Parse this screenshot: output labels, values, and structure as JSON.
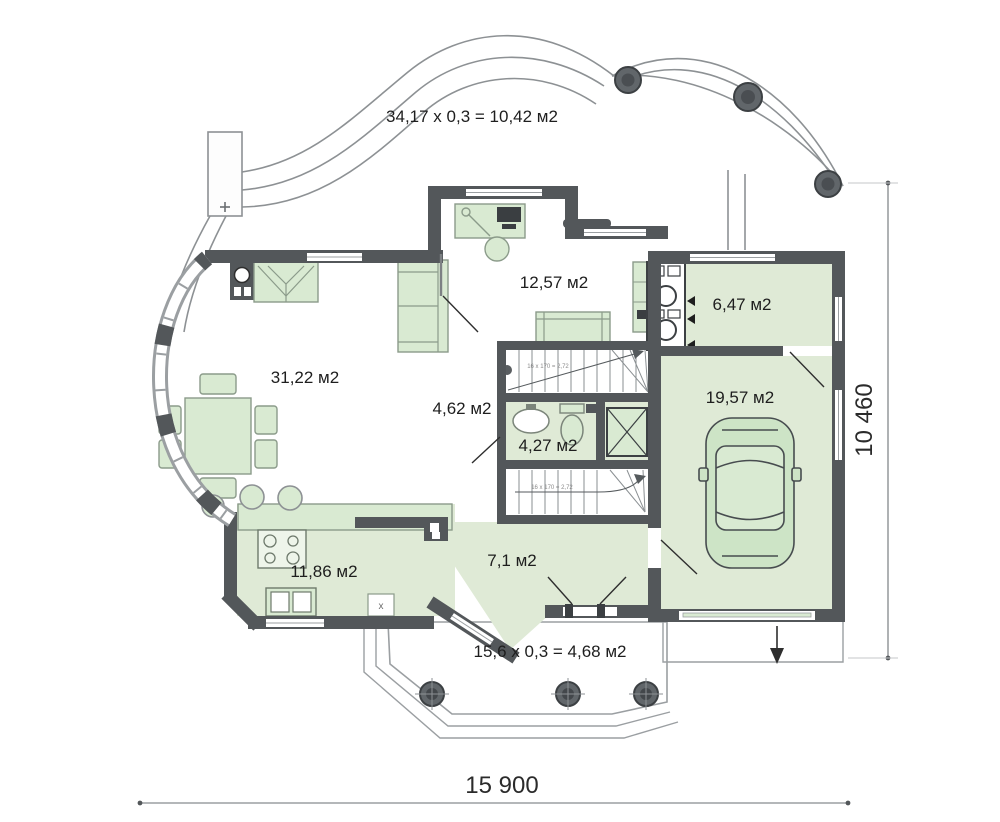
{
  "title": "Floor plan — first floor",
  "plan": {
    "rooms": [
      {
        "id": "study",
        "area": "12,57 м2"
      },
      {
        "id": "boiler-room",
        "area": "6,47 м2"
      },
      {
        "id": "garage",
        "area": "19,57 м2"
      },
      {
        "id": "living-room",
        "area": "31,22 м2"
      },
      {
        "id": "hall",
        "area": "4,62 м2"
      },
      {
        "id": "bathroom",
        "area": "4,27 м2"
      },
      {
        "id": "kitchen",
        "area": "11,86 м2"
      },
      {
        "id": "hallway",
        "area": "7,1 м2"
      }
    ],
    "annotations": {
      "terrace_formula": "34,17 x 0,3 = 10,42 м2",
      "porch_formula": "15,6 x 0,3 = 4,68 м2",
      "stair_note_upper": "16 x 170 = 2,72",
      "stair_note_lower": "16 x 170 = 2,72",
      "appliance_marker": "x"
    },
    "dimensions": {
      "overall_width_mm": "15 900",
      "overall_height_mm": "10 460"
    },
    "colors": {
      "wall": "#53575a",
      "floor_green": "#dfead6",
      "furniture_green": "#d9ead2",
      "outline_gray": "#8d9194",
      "text": "#1e1e1e"
    }
  }
}
